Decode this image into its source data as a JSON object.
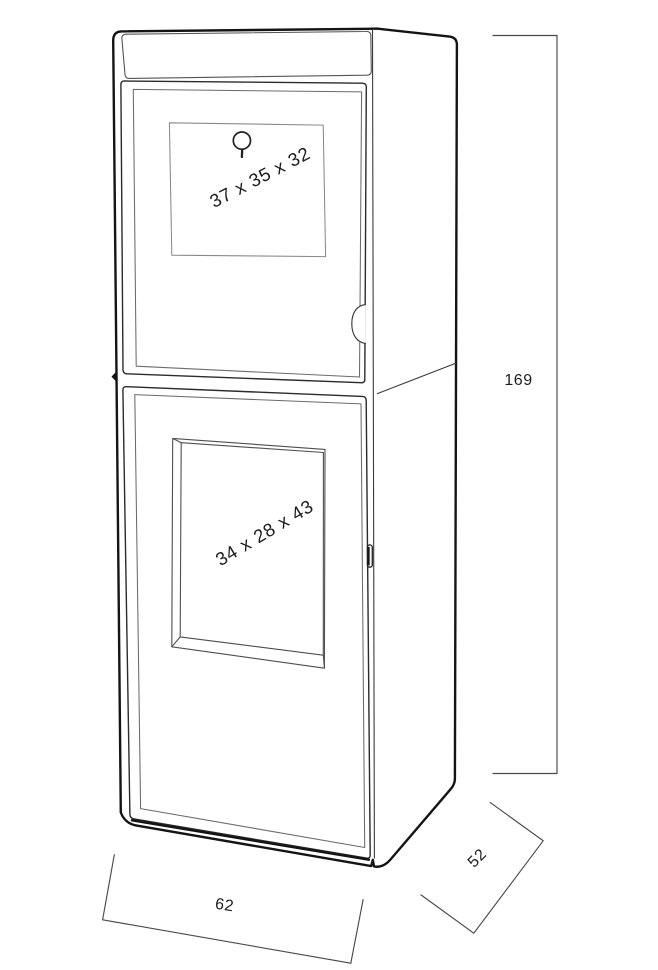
{
  "diagram": {
    "compartments": [
      {
        "position": "upper",
        "label": "37 x 35 x 32"
      },
      {
        "position": "lower",
        "label": "34 x 28 x 43"
      }
    ],
    "dimensions": {
      "height": "169",
      "depth": "52",
      "width": "62"
    },
    "colors": {
      "background": "#ffffff",
      "outline": "#141414",
      "door_line": "#2b2b2b",
      "detail_line": "#6b6b6b",
      "panel_line": "#8a8a8a",
      "dimension_line": "#4a4a4a",
      "text": "#1d1d1d"
    }
  }
}
